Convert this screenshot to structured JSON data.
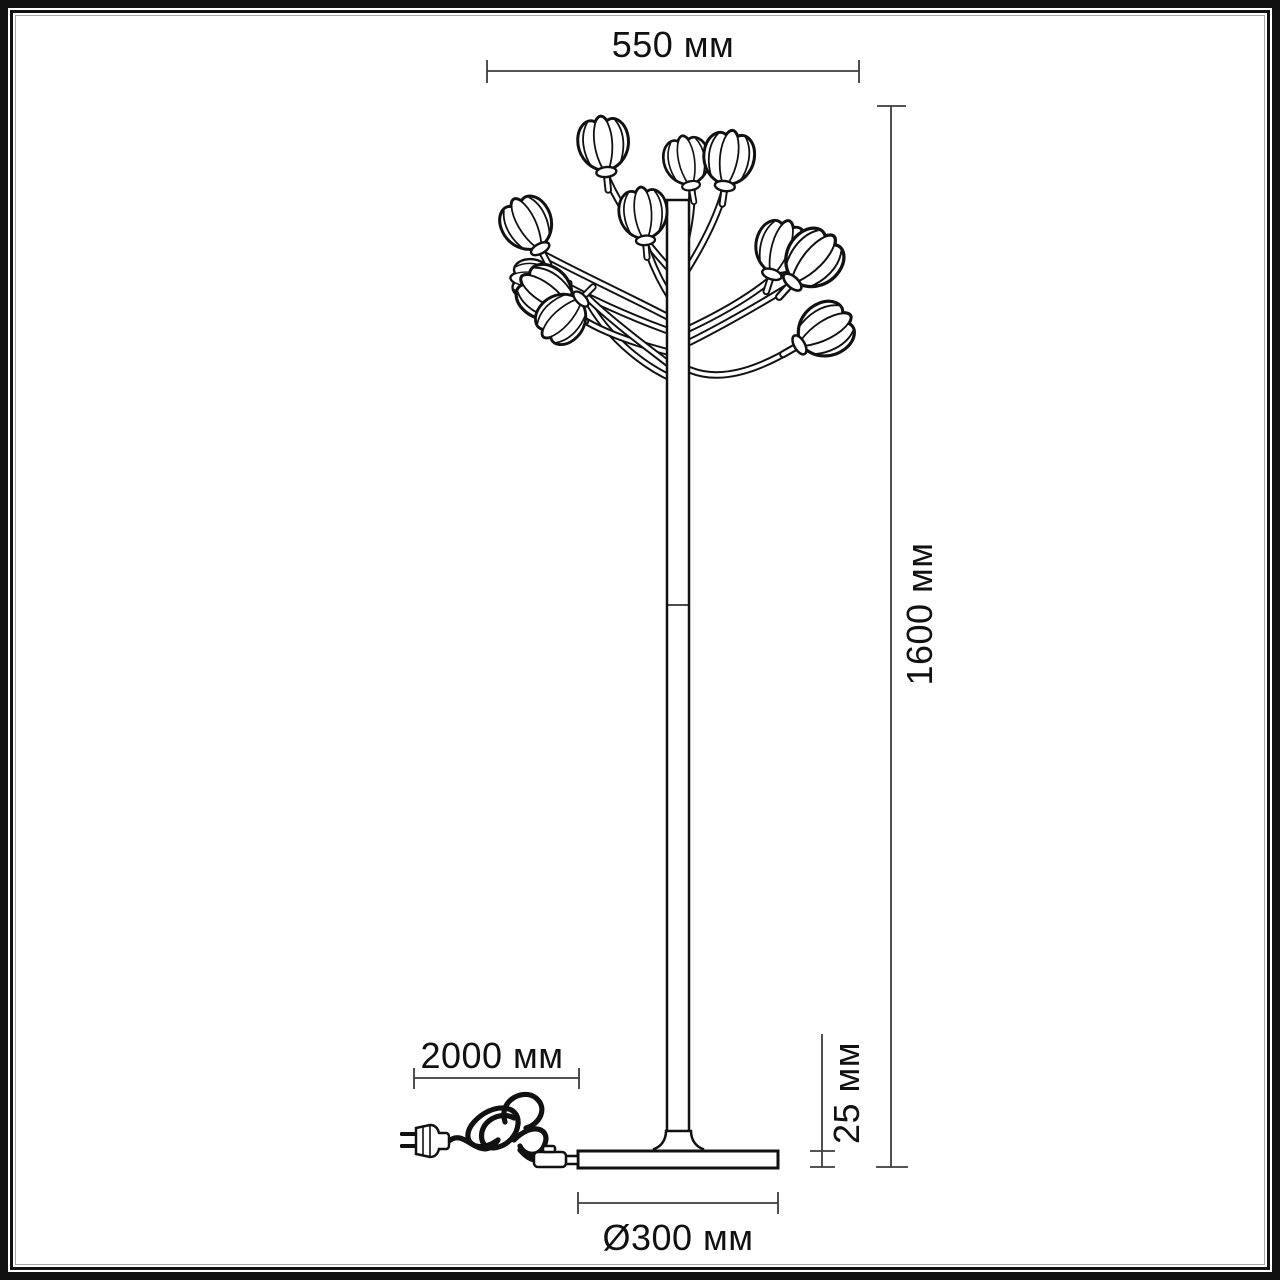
{
  "drawing_type": "floor lamp dimension diagram",
  "dimensions": {
    "top_width": "550 мм",
    "height": "1600 мм",
    "cord_length": "2000 мм",
    "base_height": "25 мм",
    "base_diameter": "Ø300 мм"
  },
  "colors": {
    "ink": "#111111",
    "dimension_line": "#3d3d3d",
    "background": "#ffffff",
    "frame_inner_line": "#a6a6a6"
  }
}
